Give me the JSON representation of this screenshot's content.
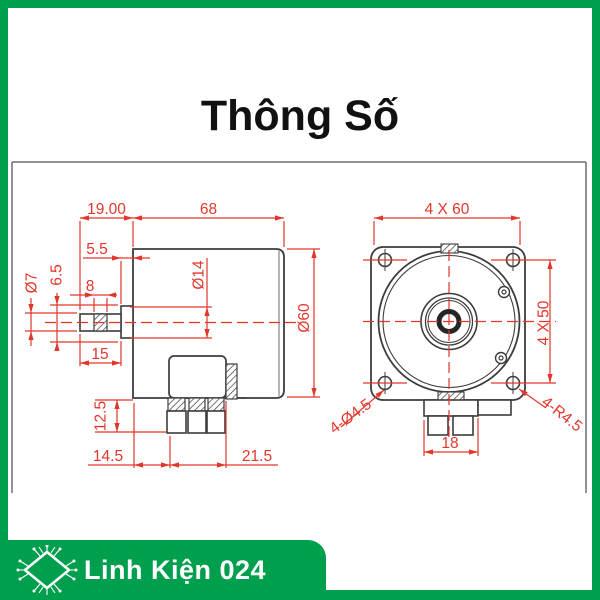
{
  "page": {
    "title": "Thông Số"
  },
  "colors": {
    "brand_green": "#009F4D",
    "dimension_red": "#E3362B",
    "drawing_line": "#3C3C3C"
  },
  "drawing": {
    "side_view": {
      "dim_shaft_total": "19.00",
      "dim_body_length": "68",
      "dim_boss_width": "5.5",
      "dim_shaft_dia": "Ø7",
      "dim_flat_width": "6.5",
      "dim_knurl": "8",
      "dim_boss_dia": "Ø14",
      "dim_shaft_length": "15",
      "dim_body_dia": "Ø60",
      "dim_pin_length": "12.5",
      "dim_pin_offset": "14.5",
      "dim_block_width": "21.5"
    },
    "front_view": {
      "dim_plate": "4 X 60",
      "dim_hole_spacing": "4 X 50",
      "dim_tabs": "18",
      "label_holes": "4-Ø4.5",
      "label_corner_radius": "4-R4.5"
    }
  },
  "footer": {
    "brand": "Linh Kiện 024"
  }
}
